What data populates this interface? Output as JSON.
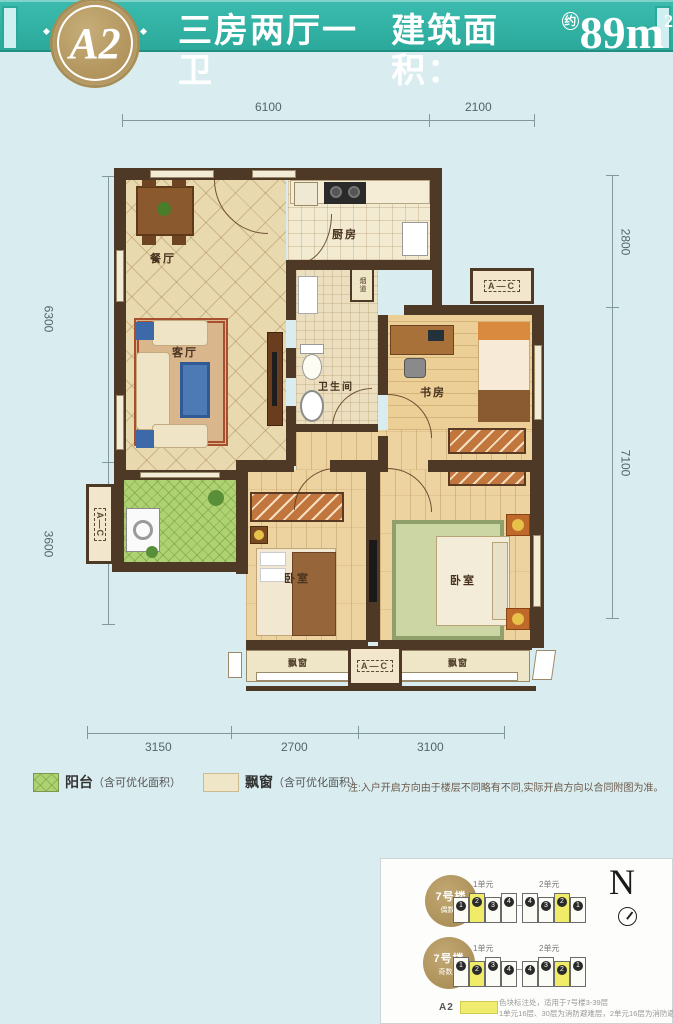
{
  "header": {
    "badge": "A2",
    "title": "三房两厅一卫",
    "area_label": "建筑面积：",
    "approx": "约",
    "area": "89m",
    "sup": "2"
  },
  "dims": {
    "top": [
      "6100",
      "2100"
    ],
    "bottom": [
      "3150",
      "2700",
      "3100"
    ],
    "left": [
      "6300",
      "3600"
    ],
    "right": [
      "2800",
      "7100"
    ]
  },
  "rooms": {
    "dining": "餐厅",
    "kitchen": "厨房",
    "living": "客厅",
    "bath": "卫生间",
    "study": "书房",
    "bedroom1": "卧室",
    "bedroom2": "卧室",
    "flue": "烟道",
    "bay1": "飘窗",
    "bay2": "飘窗",
    "ac": "A—C"
  },
  "legend": {
    "balcony_label": "阳台",
    "balcony_note": "（含可优化面积）",
    "bay_label": "飘窗",
    "bay_note": "（含可优化面积）"
  },
  "note": "注:入户开启方向由于楼层不同略有不同,实际开启方向以合同附图为准。",
  "inset": {
    "badge1_line1": "7号楼",
    "badge1_line2": "偶数层",
    "badge2_line1": "7号楼",
    "badge2_line2": "奇数层",
    "row1_unit1": "1单元",
    "row1_unit2": "2单元",
    "row2_unit1": "1单元",
    "row2_unit2": "2单元",
    "numbers": [
      "1",
      "2",
      "3",
      "4",
      "4",
      "3",
      "2",
      "1"
    ],
    "compass": "N",
    "a2_label": "A2",
    "note1": "色块标注处，适用于7号楼3-39层",
    "note2": "1单元16层、30层为消防避难层，2单元16层为消防避难层"
  }
}
